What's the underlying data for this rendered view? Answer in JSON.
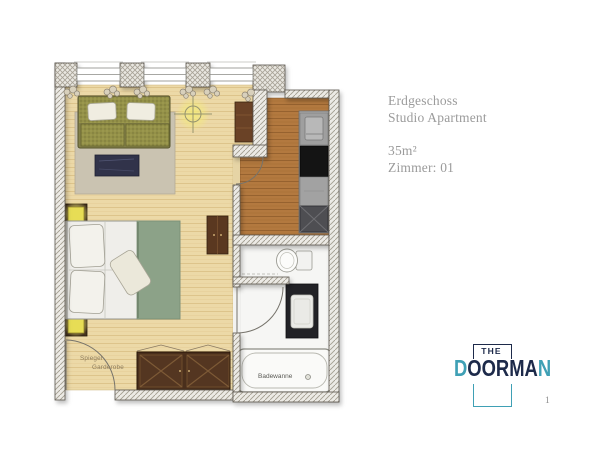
{
  "page": {
    "background": "#ffffff",
    "page_number": "1"
  },
  "info_panel": {
    "floor": "Erdgeschoss",
    "type": "Studio Apartment",
    "area": "35m²",
    "room": "Zimmer: 01",
    "text_color": "#9b9b9b"
  },
  "logo": {
    "the": "THE",
    "d": "D",
    "oorma": "OORMA",
    "n": "N",
    "navy": "#1d2a4a",
    "teal": "#3fa0b5"
  },
  "floorplan": {
    "labels": {
      "mirror": "Spiegel",
      "wardrobe": "Garderobe",
      "bathtub": "Badewanne"
    },
    "colors": {
      "living_floor": "#ecd9a7",
      "kitchen_floor": "#b3793f",
      "bath_floor": "#f6f6f4",
      "sofa_olive": "#8f8c4a",
      "bed_duvet": "#8ca288",
      "lamp_glow": "#f3ea7a",
      "wardrobe_wood": "#4a2f1c",
      "wall_hatch_line": "#a39d90"
    }
  }
}
